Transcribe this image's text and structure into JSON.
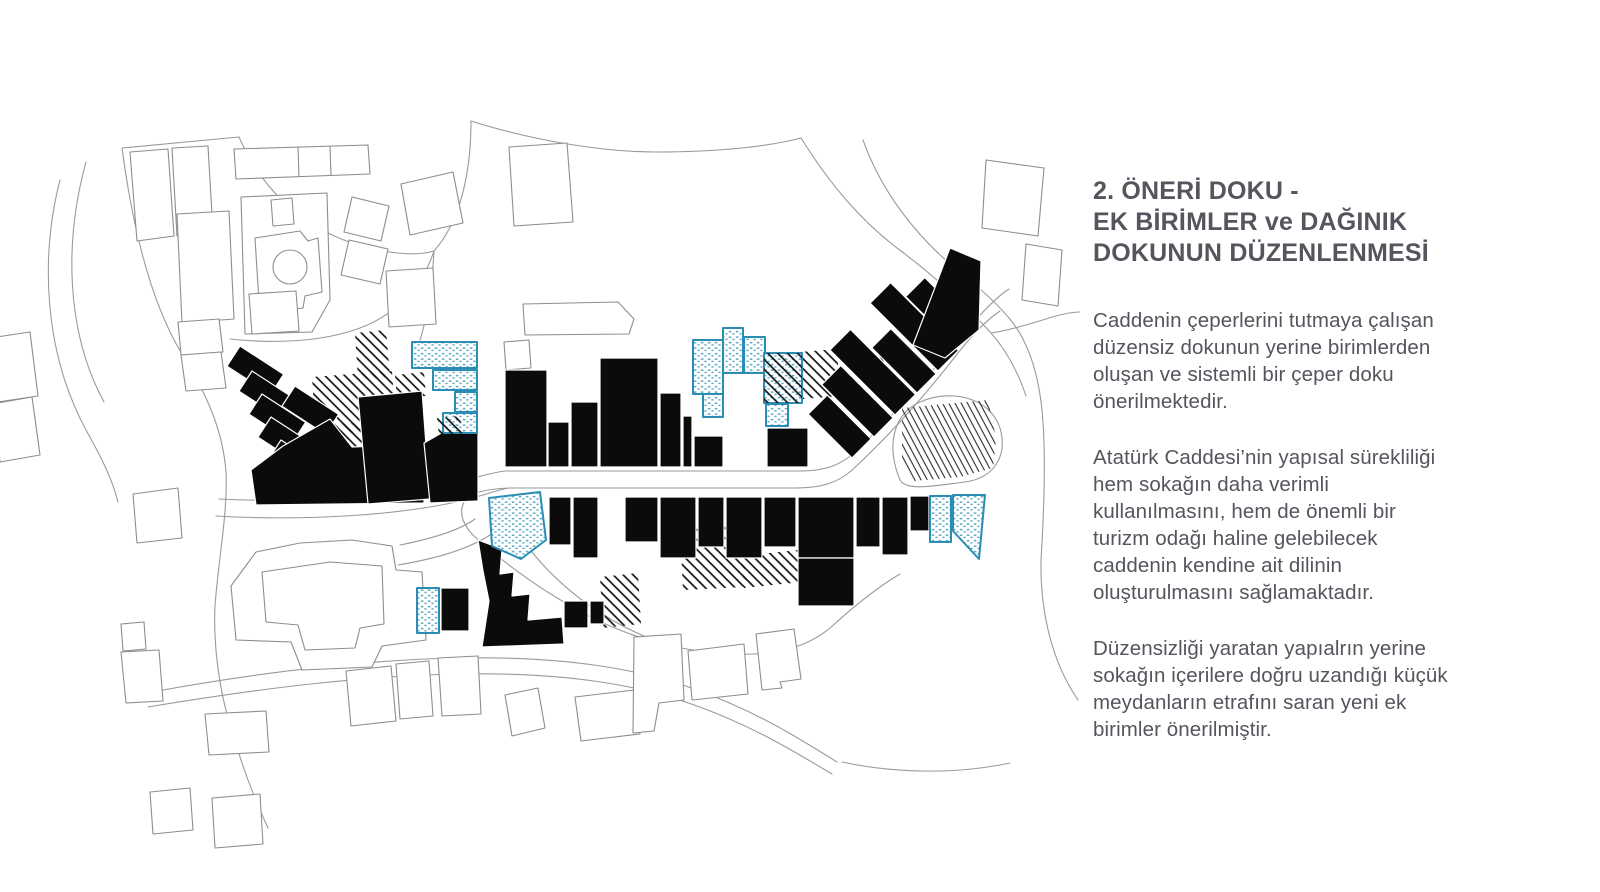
{
  "panel": {
    "heading_lines": [
      "2. ÖNERİ DOKU -",
      "EK BİRİMLER ve DAĞINIK",
      "DOKUNUN DÜZENLENMESİ"
    ],
    "paragraphs": [
      "Caddenin çeperlerini tutmaya çalışan düzensiz dokunun yerine birimlerden oluşan ve sistemli bir çeper doku önerilmektedir.",
      "Atatürk Caddesi’nin yapısal sürekliliği hem sokağın daha verimli kullanılmasını, hem de önemli bir turizm odağı haline gelebilecek caddenin kendine ait dilinin oluşturulmasını sağlamaktadır.",
      "Düzensizliği yaratan yapıalrın yerine sokağın içerilere doğru uzandığı küçük meydanların etrafını saran yeni ek birimler önerilmiştir."
    ]
  },
  "map": {
    "colors": {
      "proposed_black": "#0b0b0b",
      "additional_units_blue": "#2b8cb4",
      "additional_units_dot": "#5aa9c9",
      "context_outline": "#8d8d8d",
      "road_line": "#9a9a9a",
      "hatch": "#161616",
      "text": "#54555d"
    }
  }
}
